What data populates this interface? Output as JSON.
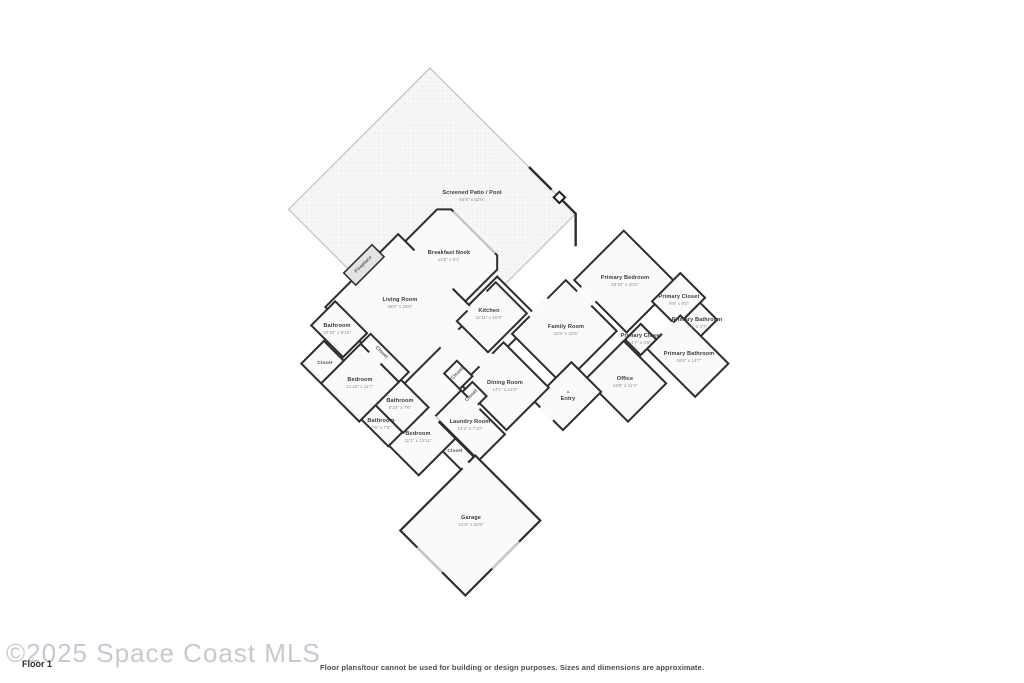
{
  "page": {
    "background": "#ffffff"
  },
  "watermark": {
    "text": "©2025 Space Coast MLS",
    "color": "#c5cad2"
  },
  "floor_label": "Floor 1",
  "disclaimer": "Floor plans/tour cannot be used for building or design purposes. Sizes and dimensions are approximate.",
  "floorplan": {
    "wall_color": "#2d2d2d",
    "room_fill": "#fafafa",
    "patio_border": "#c2c2c2",
    "window_color": "#c6c6c6",
    "rooms": [
      {
        "name": "Screened Patio / Pool",
        "dims": "64'8\" x 52'6\"",
        "x": 472,
        "y": 196
      },
      {
        "name": "Breakfast Nook",
        "dims": "13'6\" x 9'1\"",
        "x": 449,
        "y": 256
      },
      {
        "name": "Living Room",
        "dims": "28'0\" x 28'6\"",
        "x": 400,
        "y": 303
      },
      {
        "name": "Kitchen",
        "dims": "11'11\" x 10'8\"",
        "x": 489,
        "y": 314
      },
      {
        "name": "Family Room",
        "dims": "22'8\" x 20'5\"",
        "x": 566,
        "y": 330
      },
      {
        "name": "Primary Bedroom",
        "dims": "23'10\" x 20'1\"",
        "x": 625,
        "y": 281
      },
      {
        "name": "Primary Closet",
        "dims": "9'9\" x 9'2\"",
        "x": 679,
        "y": 300
      },
      {
        "name": "Primary Bathroom",
        "dims": "7'1\" x 4'7\"",
        "x": 697,
        "y": 323
      },
      {
        "name": "Primary Closet",
        "dims": "4'7\" x 4'6\"",
        "x": 641,
        "y": 339
      },
      {
        "name": "Primary Bathroom",
        "dims": "18'6\" x 14'7\"",
        "x": 689,
        "y": 357
      },
      {
        "name": "Office",
        "dims": "13'8\" x 11'4\"",
        "x": 625,
        "y": 382
      },
      {
        "name": "Entry",
        "dims": "",
        "x": 568,
        "y": 396,
        "icon": "▲"
      },
      {
        "name": "Dining Room",
        "dims": "14'1\" x 12'0\"",
        "x": 505,
        "y": 386
      },
      {
        "name": "Laundry Room",
        "dims": "14'2\" x 7'10\"",
        "x": 470,
        "y": 425
      },
      {
        "name": "Closet",
        "dims": "",
        "x": 455,
        "y": 452,
        "small": true
      },
      {
        "name": "Bedroom",
        "dims": "11'1\" x 12'11\"",
        "x": 418,
        "y": 437
      },
      {
        "name": "Bathroom",
        "dims": "8'10\" x 7'6\"",
        "x": 400,
        "y": 404
      },
      {
        "name": "Bathroom",
        "dims": "7'6\" x 7'6\"",
        "x": 381,
        "y": 424
      },
      {
        "name": "Bedroom",
        "dims": "11'10\" x 11'7\"",
        "x": 360,
        "y": 383
      },
      {
        "name": "Closet",
        "dims": "",
        "x": 325,
        "y": 364,
        "small": true
      },
      {
        "name": "Bathroom",
        "dims": "10'10\" x 5'10\"",
        "x": 337,
        "y": 329
      },
      {
        "name": "Garage",
        "dims": "21'8\" x 20'6\"",
        "x": 471,
        "y": 521
      },
      {
        "name": "Closet",
        "dims": "",
        "x": 381,
        "y": 353,
        "rotate": 45,
        "small": true
      },
      {
        "name": "Closet",
        "dims": "",
        "x": 458,
        "y": 374,
        "rotate": -45,
        "small": true
      },
      {
        "name": "Closet",
        "dims": "",
        "x": 472,
        "y": 396,
        "rotate": -45,
        "small": true
      },
      {
        "name": "Fireplace",
        "dims": "",
        "x": 364,
        "y": 265,
        "rotate": -45,
        "small": true
      }
    ]
  }
}
